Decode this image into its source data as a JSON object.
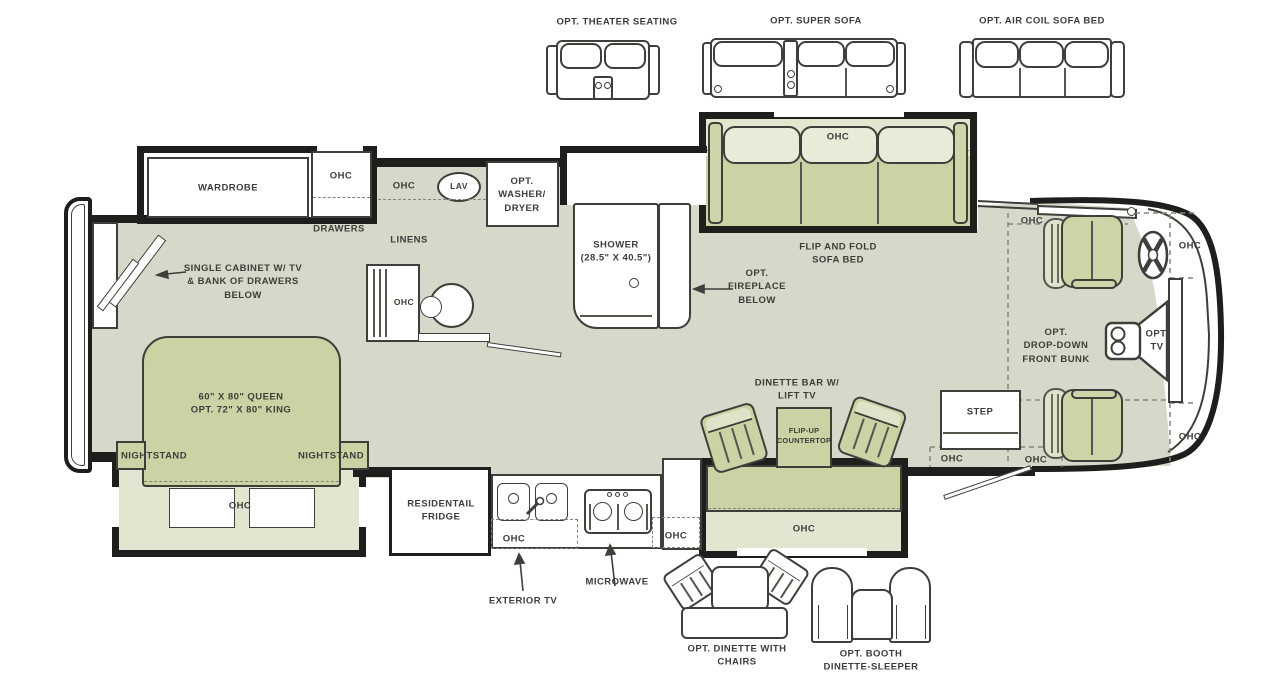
{
  "palette": {
    "floor": "#d8d8ca",
    "slide_floor": "#e3e5d0",
    "furniture_green": "#c9d3a4",
    "furniture_green_light": "#dfe3ca",
    "wall": "#1e1e1c",
    "line": "#3e3e3b",
    "text": "#3d3d3a"
  },
  "top_options": {
    "theater": "OPT. THEATER SEATING",
    "super_sofa": "OPT. SUPER SOFA",
    "air_coil": "OPT. AIR COIL SOFA BED"
  },
  "bedroom": {
    "wardrobe": "WARDROBE",
    "wardrobe_ohc": "OHC",
    "drawers": "DRAWERS",
    "cabinet_note": "SINGLE CABINET W/ TV\n& BANK OF DRAWERS\nBELOW",
    "bed": "60\" X 80\" QUEEN\nOPT. 72\" X 80\" KING",
    "nightstand_left": "NIGHTSTAND",
    "nightstand_right": "NIGHTSTAND",
    "slide_ohc": "OHC"
  },
  "bath": {
    "ohc": "OHC",
    "lav": "LAV",
    "washer": "OPT.\nWASHER/\nDRYER",
    "linens": "LINENS",
    "desk_ohc": "OHC",
    "shower": "SHOWER\n(28.5\" X 40.5\")"
  },
  "living": {
    "sofa_ohc": "OHC",
    "sofa": "FLIP AND FOLD\nSOFA BED",
    "fireplace": "OPT.\nFIREPLACE\nBELOW",
    "dinette_bar": "DINETTE BAR W/\nLIFT TV",
    "flip_up": "FLIP-UP\nCOUNTERTOP",
    "counter_ohc": "OHC",
    "step": "STEP",
    "step_ohc": "OHC"
  },
  "kitchen": {
    "fridge": "RESIDENTAIL\nFRIDGE",
    "ohc_left": "OHC",
    "ohc_right": "OHC",
    "microwave": "MICROWAVE",
    "exterior_tv": "EXTERIOR TV"
  },
  "cab": {
    "ohc_top_left": "OHC",
    "ohc_top_right": "OHC",
    "ohc_bottom_right": "OHC",
    "ohc_bottom_left": "OHC",
    "bunk": "OPT.\nDROP-DOWN\nFRONT BUNK",
    "tv": "OPT.\nTV"
  },
  "bottom_options": {
    "dinette": "OPT. DINETTE WITH\nCHAIRS",
    "booth": "OPT. BOOTH\nDINETTE-SLEEPER"
  }
}
